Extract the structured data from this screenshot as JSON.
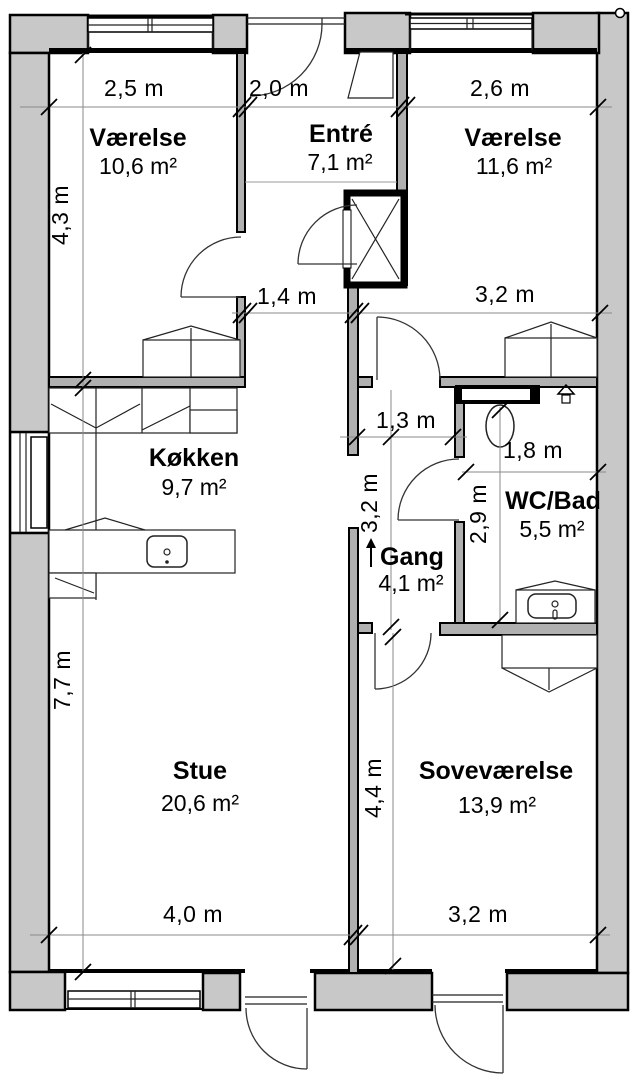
{
  "plan": {
    "type": "floor-plan",
    "language": "da",
    "wall_color": "#c8c8c8",
    "line_color": "#000000"
  },
  "rooms": {
    "vaerelse_nw": {
      "name": "Værelse",
      "area": "10,6 m²"
    },
    "entre": {
      "name": "Entré",
      "area": "7,1 m²"
    },
    "vaerelse_ne": {
      "name": "Værelse",
      "area": "11,6 m²"
    },
    "koekken": {
      "name": "Køkken",
      "area": "9,7 m²"
    },
    "gang": {
      "name": "Gang",
      "area": "4,1 m²"
    },
    "wc_bad": {
      "name": "WC/Bad",
      "area": "5,5 m²"
    },
    "stue": {
      "name": "Stue",
      "area": "20,6 m²"
    },
    "sovevaerelse": {
      "name": "Soveværelse",
      "area": "13,9 m²"
    }
  },
  "dimensions": {
    "top_left": "2,5 m",
    "top_middle": "2,0 m",
    "top_right": "2,6 m",
    "left_upper": "4,3 m",
    "left_lower": "7,7 m",
    "mid_corridor": "1,4 m",
    "mid_room": "3,2 m",
    "vestibule_width": "1,3 m",
    "gang_height": "3,2 m",
    "wc_width": "1,8 m",
    "wc_height": "2,9 m",
    "sove_height": "4,4 m",
    "bottom_left": "4,0 m",
    "bottom_right": "3,2 m"
  }
}
